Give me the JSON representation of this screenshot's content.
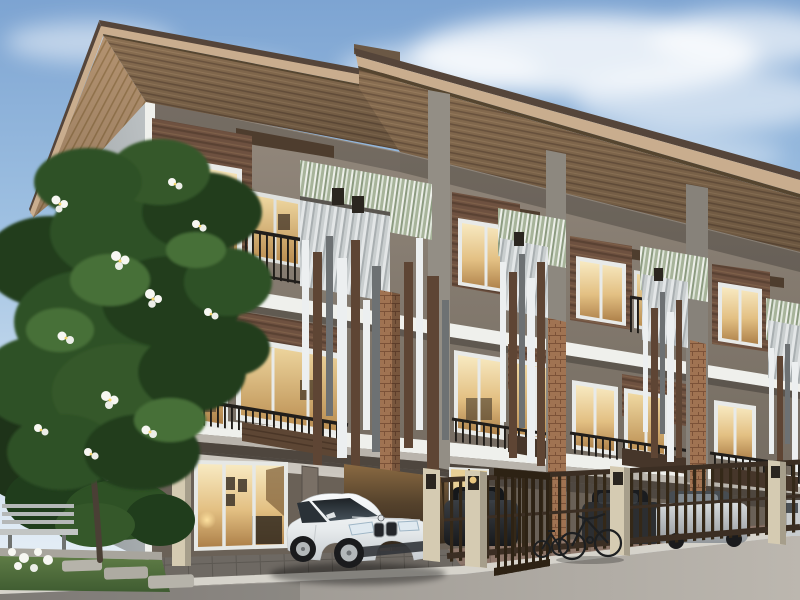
{
  "meta": {
    "title": "Three-storey modern townhome row — daytime architectural rendering",
    "description": "Row of three-storey brown and grey townhouses with vertical slat screens, corrugated privacy panels, glass balconies, warm-lit interiors, a white coupe in the nearest carport, dark cars and a silver sedan behind brown steel gates, two bicycles, a frangipani tree with white blossoms, a grey bench and lawn at left, under a blue sky with soft clouds."
  },
  "scene": {
    "sky": {
      "condition": "clear with wispy white clouds"
    },
    "building": {
      "storeys": 3,
      "visible_units": 4,
      "materials": [
        "brown horizontal wood siding",
        "grey render walls",
        "white concrete slab bands",
        "black steel railings",
        "vertical slat fins (brown, white, grey)",
        "corrugated metal screens (silver, sage green)",
        "terracotta brick piers"
      ],
      "ground_floor": [
        "glass sliding doors with warm interior light",
        "open carport",
        "brown steel gates",
        "cream gate piers with wall lamps"
      ]
    },
    "vehicles": [
      {
        "label": "white coupe",
        "position": "carport of nearest unit"
      },
      {
        "label": "dark car behind gate",
        "position": "unit 2 garage"
      },
      {
        "label": "dark car behind gate",
        "position": "unit 3 garage"
      },
      {
        "label": "silver sedan behind gate",
        "position": "unit 3 garage"
      },
      {
        "label": "light car partially visible",
        "position": "right edge"
      }
    ],
    "bicycles": [
      {
        "label": "road bicycle"
      },
      {
        "label": "small bicycle"
      }
    ],
    "landscape": [
      {
        "label": "frangipani tree with white blossoms"
      },
      {
        "label": "grey garden bench"
      },
      {
        "label": "white ground flowers"
      },
      {
        "label": "lawn with stepping stones"
      },
      {
        "label": "hedge shrubs"
      }
    ],
    "road": {
      "surface": "asphalt",
      "curb": "light concrete gutter",
      "aprons": [
        "dark grey pavers",
        "brown pavers"
      ]
    }
  },
  "colors": {
    "sky_top": "#7da4d2",
    "sky_horizon": "#ecf2f8",
    "cloud": "#ffffff",
    "roof_fascia": "#c9ad8e",
    "roof_top": "#55453a",
    "roof_step": "#6b5845",
    "soffit_front": "#8a6f52",
    "soffit_left": "#b39270",
    "wall_end": "#a7adaf",
    "wall_facade": "#877e74",
    "wall_ground": "#6a6157",
    "trim_white": "#eff0ec",
    "slab_mid": "#b9b4ac",
    "slab_dark": "#4e463e",
    "siding_brown": "#6e5140",
    "canopy_brown": "#4e3d2e",
    "railing_black": "#211e1b",
    "parapet_dark": "#46362a",
    "glass_warm": "#e8cf96",
    "glass_cool": "#aebfcc",
    "glass_panel": "#716d62",
    "corrugate_silver": "#cdd2d3",
    "corrugate_green": "#a7b49a",
    "fin_white": "#eceff0",
    "fin_brown": "#5e4534",
    "fin_gray": "#6d7173",
    "brick_pier": "#a07352",
    "gate_brown": "#3b2e23",
    "pier_cream": "#d5cbb2",
    "lamp_dark": "#2b2620",
    "lamp_glow": "#ffd98a",
    "car_white": "#f0f2f3",
    "car_dark": "#232529",
    "car_silver": "#c3c7ca",
    "tire_black": "#1a1b1d",
    "rim_silver": "#b3b8ba",
    "pavers_dark": "#6e6963",
    "pavers_brown": "#8d766a",
    "curb": "#d6d3cb",
    "road_left": "#8f8b86",
    "road_right": "#b9b4ac",
    "grass": "#5f7c46",
    "leaf_dark": "#203d1c",
    "leaf_mid": "#2e5125",
    "leaf_light": "#466f38",
    "flower_white": "#f7f7f2",
    "flower_center": "#f5d66a",
    "bench_gray": "#b5b8b8",
    "trunk": "#4a3f35",
    "door_plain": "#7a7066"
  }
}
